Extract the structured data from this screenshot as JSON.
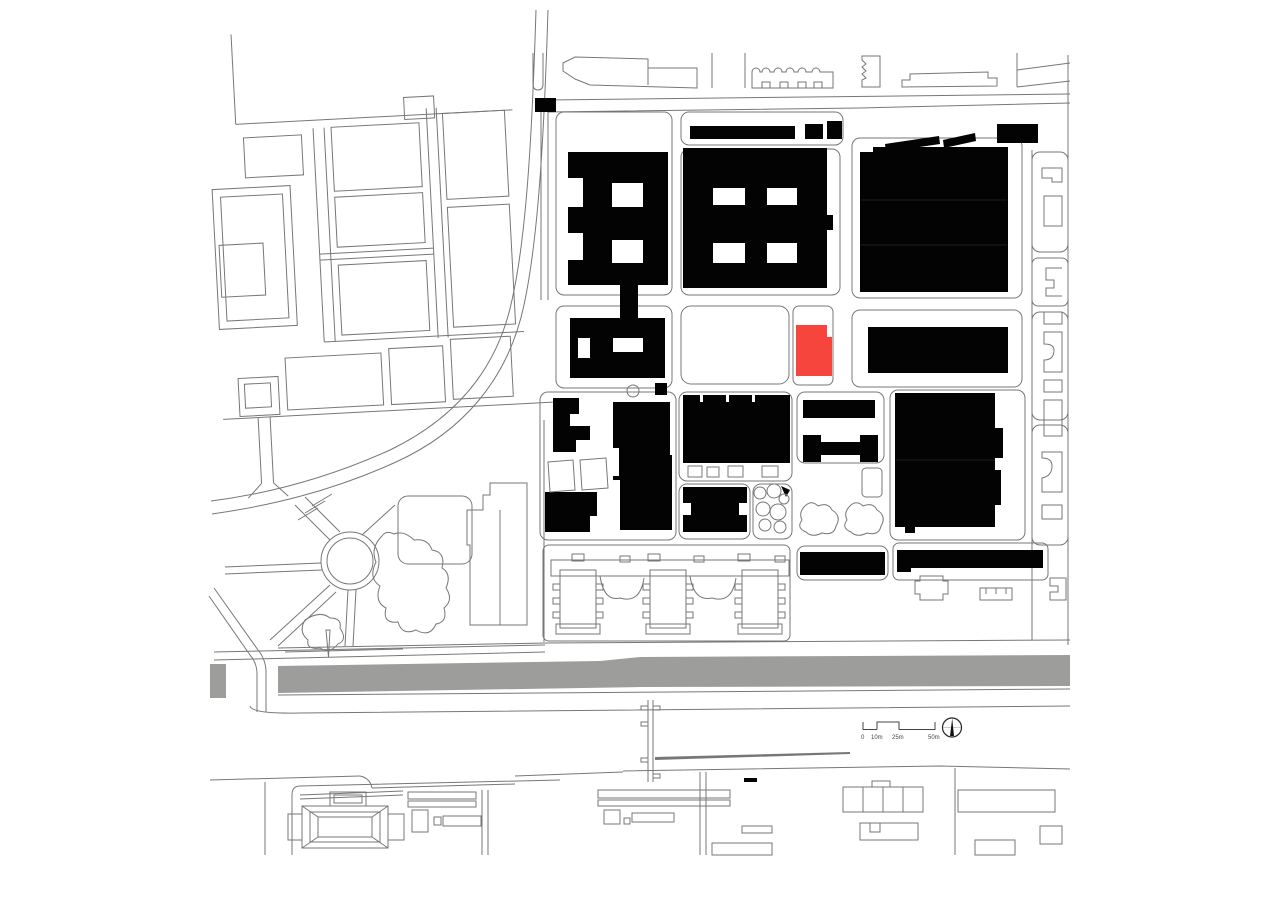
{
  "page": {
    "background": "#ffffff"
  },
  "plan": {
    "line_color": "#777777",
    "line_color_dark": "#444444",
    "building_color": "#030303",
    "site_color": "#f5453c",
    "water_color": "#9d9d9c"
  },
  "scale_bar": {
    "labels": [
      "0",
      "10m",
      "25m",
      "50m"
    ]
  }
}
